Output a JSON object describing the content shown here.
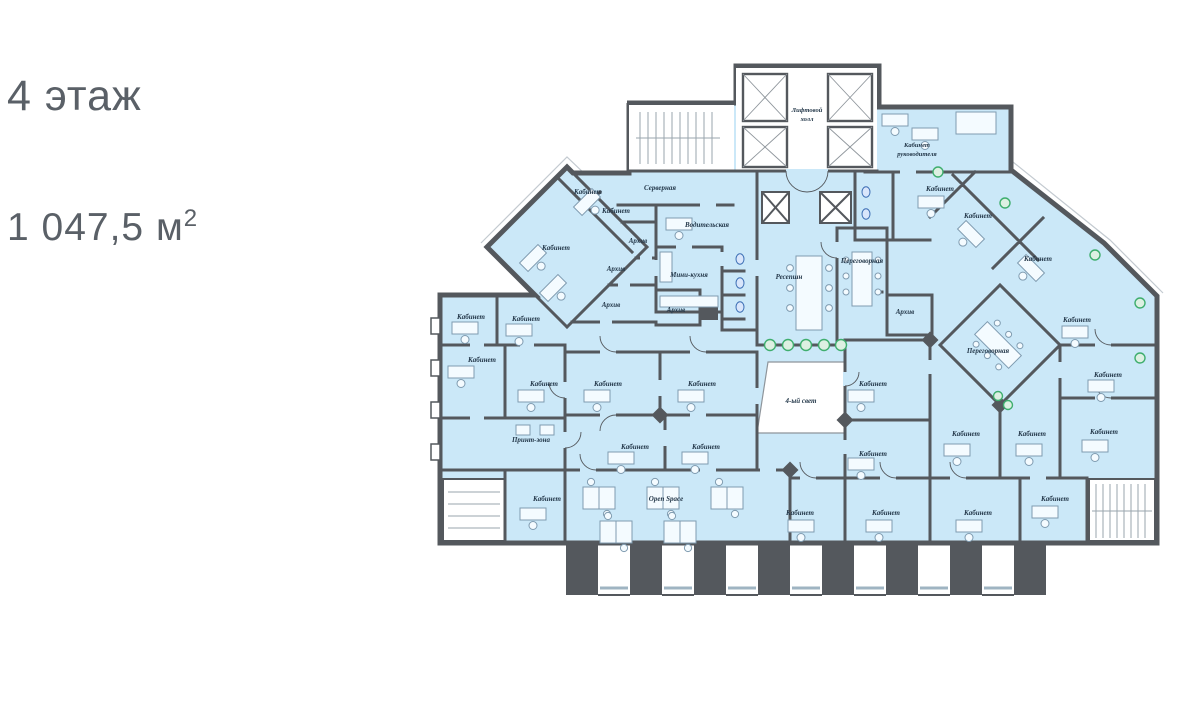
{
  "page": {
    "floor_title": "4 этаж",
    "area_value": "1 047,5 м",
    "area_superscript": "2"
  },
  "rooms": {
    "office": "Кабинет",
    "director_office_line1": "Кабинет",
    "director_office_line2": "руководителя",
    "server_room": "Серверная",
    "driver_room": "Водительская",
    "mini_kitchen": "Мини-кухня",
    "archive": "Архив",
    "reception": "Ресепшн",
    "meeting_room": "Переговорная",
    "print_zone": "Принт-зона",
    "open_space": "Open Space",
    "elevator_hall_line1": "Лифтовой",
    "elevator_hall_line2": "холл",
    "atrium": "4-ый свет"
  },
  "colors": {
    "floor_fill": "#cbe8f8",
    "walls": "#54585d",
    "label_text": "#24384a",
    "plant_green": "#3fae6e",
    "title_text": "#5a6067"
  }
}
